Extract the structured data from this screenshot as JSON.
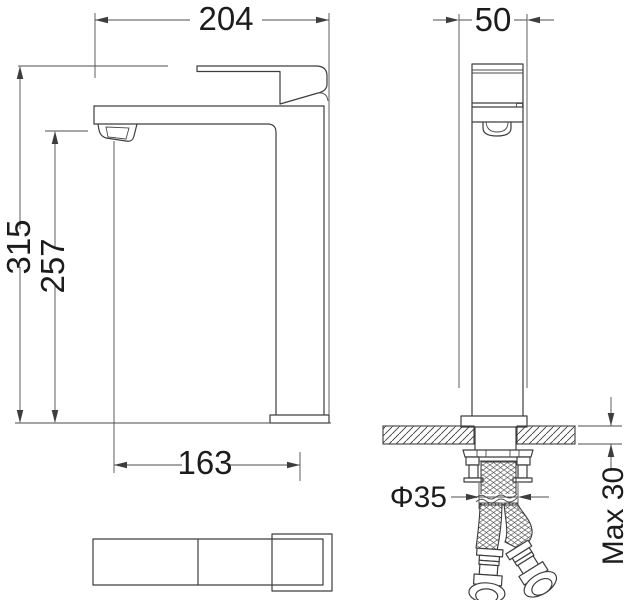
{
  "drawing": {
    "background": "#ffffff",
    "line_color": "#3d3d3d",
    "text_color": "#1c1c1c"
  },
  "dimensions": {
    "overall_width": "204",
    "front_width": "50",
    "overall_height": "315",
    "spout_outlet_height": "257",
    "spout_reach": "163",
    "shank_diameter": "Φ35",
    "max_counter_thickness": "Max 30"
  }
}
